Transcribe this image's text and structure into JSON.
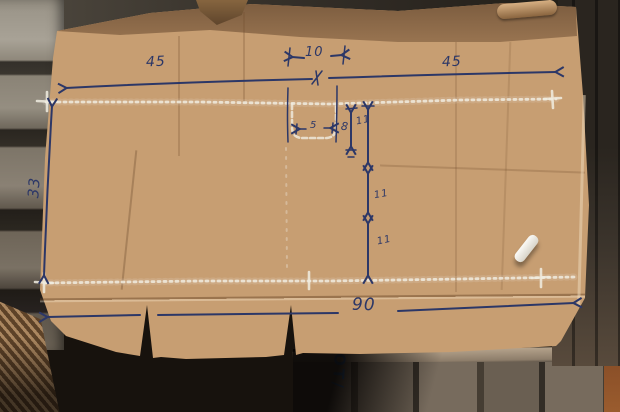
{
  "measurements": {
    "top_left_width": "45",
    "top_center_gap": "10",
    "top_right_width": "45",
    "left_height": "33",
    "slot_width": "5",
    "slot_depth": "8",
    "center_segments": [
      "11",
      "11",
      "11"
    ],
    "bottom_width": "90"
  },
  "stamp": {
    "text": "OT/"
  },
  "colors": {
    "ink": "#2c3767",
    "chalk": "#f0ece1",
    "board": "#c79e72",
    "band": "#8a6647",
    "stamp_blue": "#2f6fbe"
  }
}
